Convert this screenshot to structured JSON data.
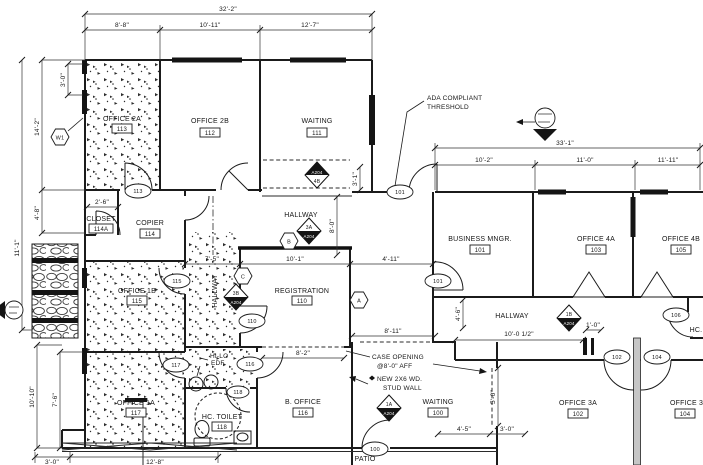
{
  "drawing": {
    "rooms": {
      "office_2a": {
        "name": "OFFICE 2A",
        "num": "113"
      },
      "office_2b": {
        "name": "OFFICE 2B",
        "num": "112"
      },
      "waiting_111": {
        "name": "WAITING",
        "num": "111"
      },
      "closet": {
        "name": "CLOSET",
        "num": "114A"
      },
      "copier": {
        "name": "COPIER",
        "num": "114"
      },
      "hallway_top": {
        "name": "HALLWAY"
      },
      "hallway_vert": {
        "name": "HALLWAY"
      },
      "hallway_right": {
        "name": "HALLWAY"
      },
      "registration": {
        "name": "REGISTRATION",
        "num": "110"
      },
      "office_1b": {
        "name": "OFFICE 1B",
        "num": "115"
      },
      "office_1a": {
        "name": "OFFICE 1A",
        "num": "117"
      },
      "hc_toilet": {
        "name": "HC. TOILET",
        "num": "118"
      },
      "b_office": {
        "name": "B. OFFICE",
        "num": "116"
      },
      "waiting_100": {
        "name": "WAITING",
        "num": "100"
      },
      "business_mngr": {
        "name": "BUSINESS MNGR.",
        "num": "101"
      },
      "office_4a": {
        "name": "OFFICE 4A",
        "num": "103"
      },
      "office_4b": {
        "name": "OFFICE 4B",
        "num": "105"
      },
      "office_3a": {
        "name": "OFFICE 3A",
        "num": "102"
      },
      "office_3b": {
        "name": "OFFICE 3B",
        "num": "104"
      },
      "patio": {
        "name": "PATIO"
      },
      "hc_partial": {
        "name": "HC."
      }
    },
    "dims": {
      "top_total": "32'-2\"",
      "top_1": "8'-8\"",
      "top_2": "10'-11\"",
      "top_3": "12'-7\"",
      "left_1": "3'-0\"",
      "left_2": "14'-2\"",
      "left_3": "4'-8\"",
      "left_4": "11'-1\"",
      "left_5": "10'-10\"",
      "left_6": "7'-6\"",
      "right_total": "33'-1\"",
      "right_1": "10'-2\"",
      "right_2": "11'-0\"",
      "right_3": "11'-11\"",
      "mid_1": "7'-5\"",
      "mid_2": "10'-1\"",
      "mid_3": "4'-11\"",
      "v_8_0": "8'-0\"",
      "v_3_1": "3'-1\"",
      "closet": "2'-6\"",
      "b_office": "8'-2\"",
      "case": "8'-11\"",
      "v_5_0": "5'-0\"",
      "wait_1": "4'-5\"",
      "wait_2": "3'-0\"",
      "hall_1": "10'-0 1/2\"",
      "hall_2": "1'-0\"",
      "v_4_6": "4'-6\"",
      "bot_1": "3'-0\"",
      "bot_2": "12'-8\""
    },
    "notes": {
      "ada_1": "ADA COMPLIANT",
      "ada_2": "THRESHOLD",
      "case_1": "CASE OPENING",
      "case_2": "@8'-0\" AFF",
      "stud_1": "NEW 2X6 WD.",
      "stud_2": "STUD WALL",
      "hilo_1": "HI-LO",
      "hilo_2": "EDF"
    },
    "door_tags": {
      "t113": "113",
      "t101_ext": "101",
      "t101_int": "101",
      "t110": "110",
      "t115": "115",
      "t116": "116",
      "t117": "117",
      "t118": "118",
      "t100": "100",
      "t102": "102",
      "t104": "104",
      "t106": "106"
    },
    "ref_tags": {
      "w1": "W1",
      "a": "A",
      "b": "B",
      "c": "C"
    },
    "markers": {
      "m4b": {
        "top": "A204",
        "bottom": "4B"
      },
      "m3a": {
        "top": "3A",
        "bottom": "A204"
      },
      "m3b": {
        "top": "3B",
        "bottom": "A204"
      },
      "m1a": {
        "top": "1A",
        "bottom": "A204"
      },
      "m1b": {
        "top": "1B",
        "bottom": "A204"
      }
    },
    "colors": {
      "line": "#1b1b1b",
      "background": "#ffffff",
      "wall_poche": "#c6c6c6"
    }
  }
}
